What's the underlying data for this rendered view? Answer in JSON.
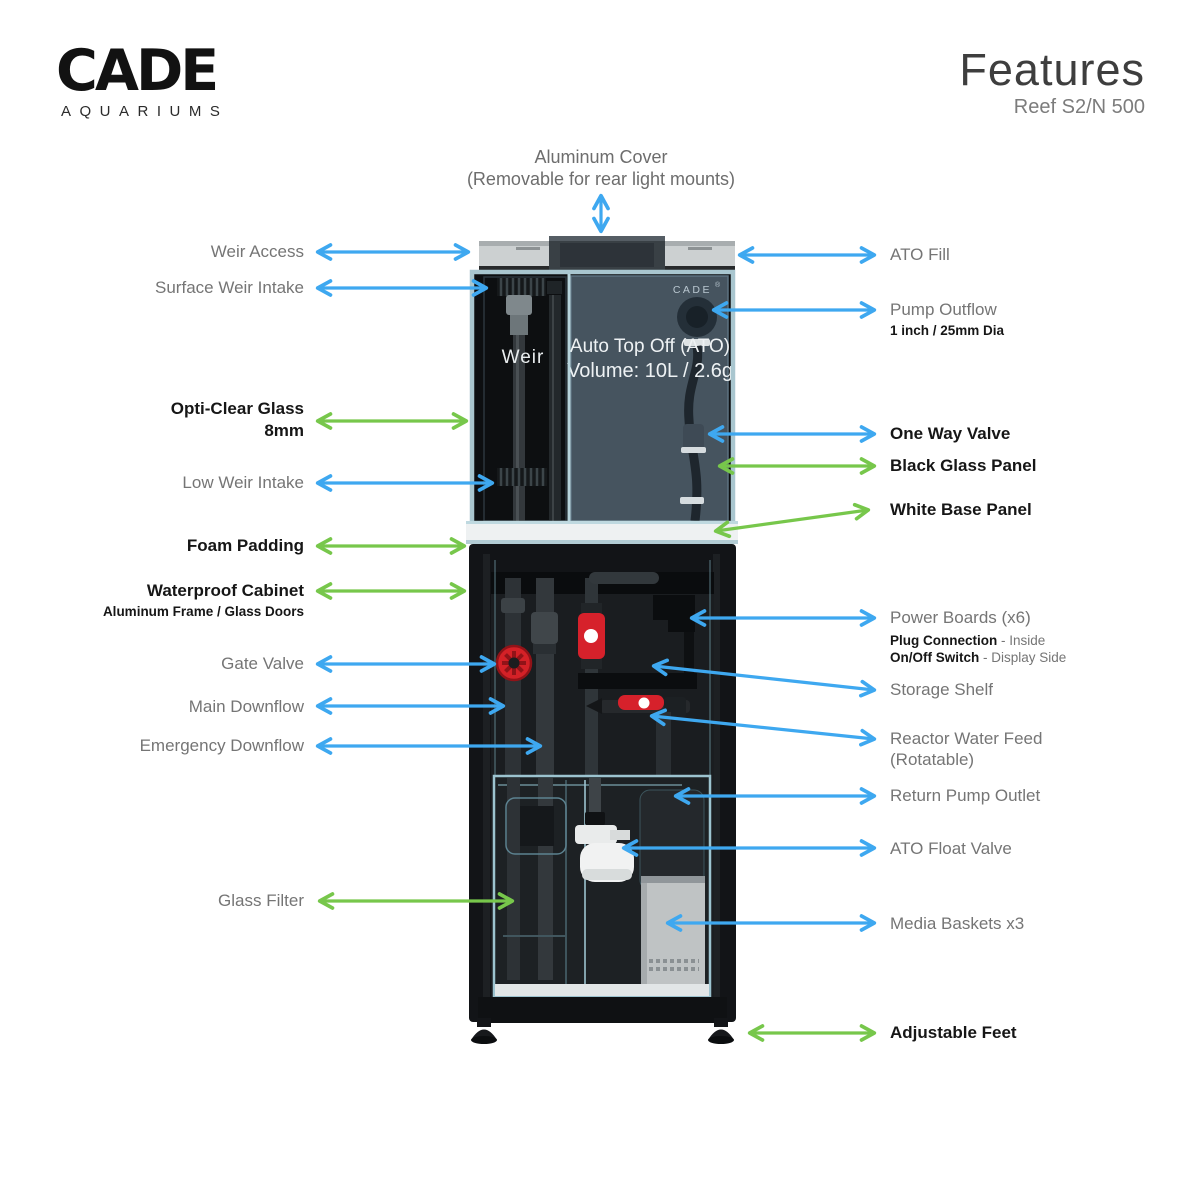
{
  "logo": {
    "brand": "CADE",
    "tagline": "AQUARIUMS"
  },
  "header": {
    "title": "Features",
    "subtitle": "Reef S2/N 500"
  },
  "colors": {
    "arrow_blue": "#3EA8F0",
    "arrow_green": "#77C74B",
    "valve_red": "#d42127",
    "tank_slate": "#46545f"
  },
  "top_callout": {
    "line1": "Aluminum Cover",
    "line2": "(Removable for rear light mounts)"
  },
  "tank": {
    "weir_label": "Weir",
    "brand": "CADE",
    "registered": "®",
    "ato_line1": "Auto Top Off (ATO)",
    "ato_line2": "Volume: 10L / 2.6g"
  },
  "left_callouts": [
    {
      "label": "Weir Access"
    },
    {
      "label": "Surface Weir Intake"
    },
    {
      "line1": "Opti-Clear Glass",
      "line2": "8mm"
    },
    {
      "label": "Low Weir Intake"
    },
    {
      "label": "Foam Padding"
    },
    {
      "label": "Waterproof Cabinet",
      "sub": "Aluminum Frame / Glass Doors"
    },
    {
      "label": "Gate Valve"
    },
    {
      "label": "Main Downflow"
    },
    {
      "label": "Emergency Downflow"
    },
    {
      "label": "Glass Filter"
    }
  ],
  "right_callouts": [
    {
      "label": "ATO Fill"
    },
    {
      "label": "Pump Outflow",
      "sub": "1 inch / 25mm Dia"
    },
    {
      "label": "One Way Valve"
    },
    {
      "label": "Black Glass Panel"
    },
    {
      "label": "White Base Panel"
    },
    {
      "label": "Power Boards (x6)",
      "sub1_strong": "Plug Connection",
      "sub1_rest": " - Inside",
      "sub2_strong": "On/Off Switch",
      "sub2_rest": " - Display Side"
    },
    {
      "label": "Storage Shelf"
    },
    {
      "line1": "Reactor Water Feed",
      "line2": "(Rotatable)"
    },
    {
      "label": "Return Pump Outlet"
    },
    {
      "label": "ATO Float Valve"
    },
    {
      "label": "Media Baskets x3"
    },
    {
      "label": "Adjustable Feet"
    }
  ]
}
